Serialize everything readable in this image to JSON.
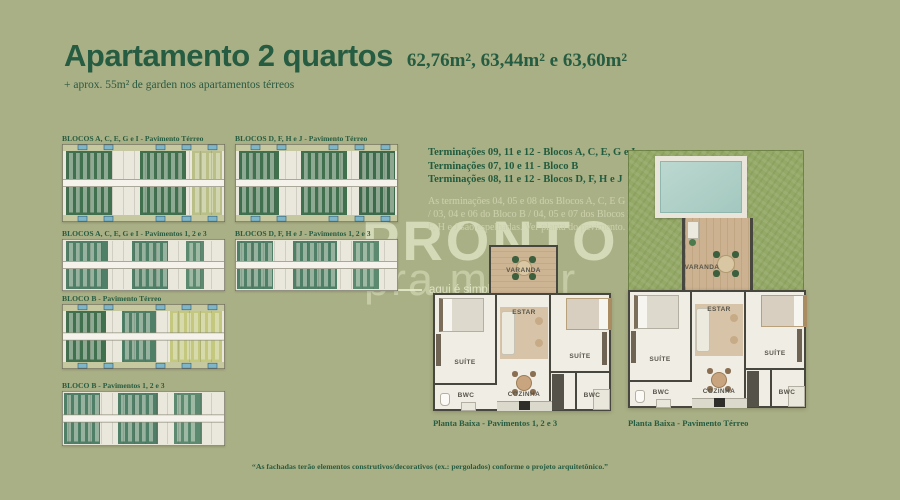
{
  "page": {
    "title": "Apartamento 2 quartos",
    "areas": "62,76m², 63,44m² e 63,60m²",
    "subtitle": "+ aprox. 55m² de garden nos apartamentos térreos",
    "footnote": "“As fachadas terão elementos construtivos/decorativos (ex.: pergolados) conforme o projeto arquitetônico.”"
  },
  "block_diagrams": [
    {
      "label": "BLOCOS A, C, E, G e I - Pavimento Térreo"
    },
    {
      "label": "BLOCOS D, F, H e J - Pavimento Térreo"
    },
    {
      "label": "BLOCOS A, C, E, G e I - Pavimentos 1, 2 e 3"
    },
    {
      "label": "BLOCOS D, F, H e J - Pavimentos 1, 2 e 3"
    },
    {
      "label": "BLOCO B - Pavimento Térreo"
    },
    {
      "label": "BLOCO B - Pavimentos 1, 2 e 3"
    }
  ],
  "terminacoes": {
    "lines": [
      "Terminações 09, 11 e 12 - Blocos A, C, E, G e I",
      "Terminações 07, 10 e 11 - Bloco B",
      "Terminações 08, 11 e 12 - Blocos D, F, H e J"
    ],
    "note": "As terminações 04, 05 e 08 dos Blocos A, C, E G e I / 03, 04 e 06 do Bloco B / 04, 05 e 07 dos Blocos D, F, H e J são espelhadas. Ver planta do pavimento."
  },
  "watermark": {
    "brand_line1": "PRONTO",
    "brand_line2": "pra morar",
    "tagline": "aqui é simples"
  },
  "floor_plans": [
    {
      "caption": "Planta Baixa - Pavimentos 1, 2 e 3",
      "rooms": {
        "varanda": "VARANDA",
        "estar": "ESTAR",
        "suite_left": "SUÍTE",
        "suite_right": "SUÍTE",
        "cozinha": "COZINHA",
        "bwc_left": "BWC",
        "bwc_right": "BWC"
      }
    },
    {
      "caption": "Planta Baixa - Pavimento Térreo",
      "rooms": {
        "varanda": "VARANDA",
        "estar": "ESTAR",
        "suite_left": "SUÍTE",
        "suite_right": "SUÍTE",
        "cozinha": "COZINHA",
        "bwc_left": "BWC",
        "bwc_right": "BWC"
      }
    }
  ],
  "colors": {
    "background": "#aab086",
    "text_dark_green": "#265c41",
    "watermark_cream": "#e3e8c8",
    "grass": "#95a967",
    "pool_water": "#aed0c8",
    "garden_dark_green": "#41704f",
    "unit_teal": "#4f7f66",
    "strip_pool_blue": "#7eb5c7"
  }
}
